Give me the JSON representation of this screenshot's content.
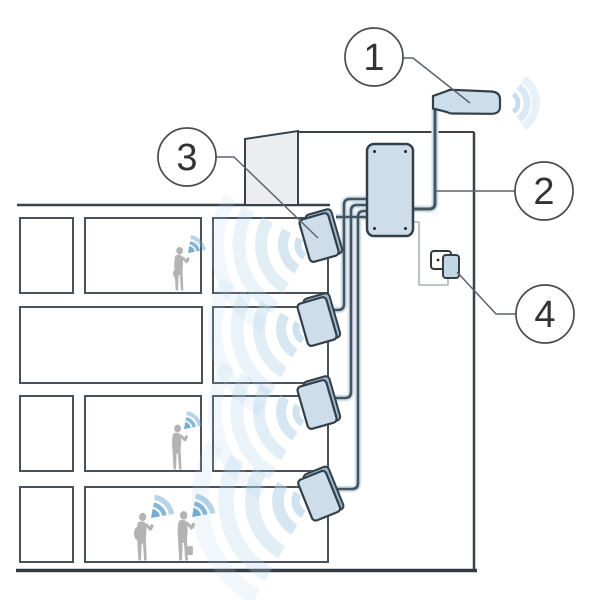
{
  "figure": {
    "type": "installation-diagram",
    "callouts": [
      {
        "number": "1",
        "target": "outdoor-donor-antenna"
      },
      {
        "number": "2",
        "target": "coax-cable-to-amplifier"
      },
      {
        "number": "3",
        "target": "indoor-panel-antenna"
      },
      {
        "number": "4",
        "target": "power-outlet"
      }
    ],
    "colors": {
      "device_fill": "#cdddea",
      "device_side": "#9db9d0",
      "device_stroke": "#333f49",
      "line": "#49525c",
      "cable_core": "#45555e",
      "cable_halo": "#d2e1ed",
      "wave": "#aecfe6",
      "phone_wave": "#5f9dc9",
      "person": "#b3b3b3",
      "power_cable": "#b6bcc2",
      "roof_fill": "#ebedee",
      "callout_text": "#333333"
    }
  }
}
